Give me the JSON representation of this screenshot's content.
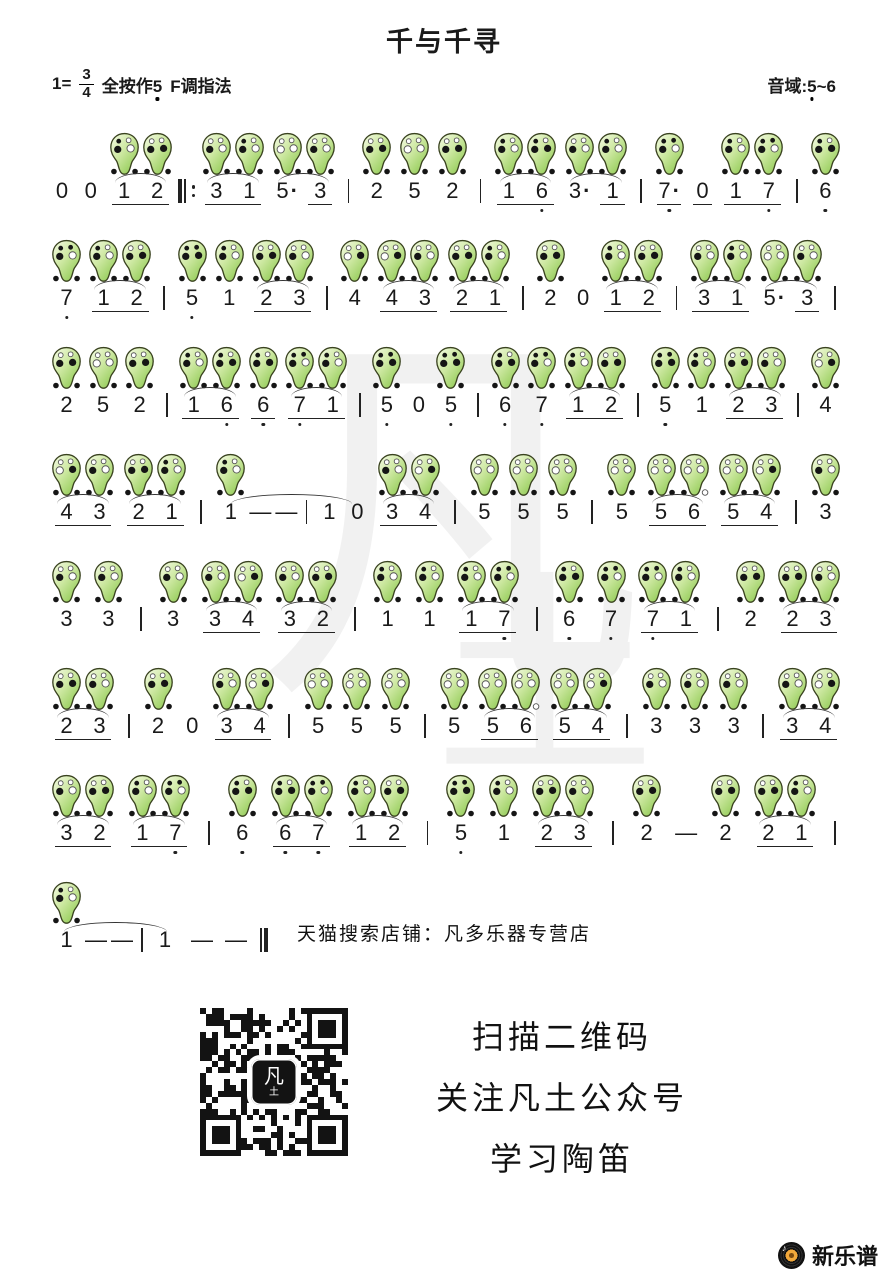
{
  "header": {
    "title": "千与千寻",
    "key": {
      "scale": "1=",
      "num": "3",
      "den": "4",
      "press": "全按作",
      "press_note": "5",
      "fingering": "F调指法"
    },
    "range": {
      "prefix": "音域:",
      "low": "5",
      "sep": "~",
      "high": "6"
    }
  },
  "watermark": {
    "main": "凡",
    "sub": "土"
  },
  "score": {
    "rows": [
      [
        {
          "k": "n",
          "t": "0"
        },
        {
          "k": "n",
          "t": "0"
        },
        {
          "k": "g",
          "slur": true,
          "ul": true,
          "n": [
            {
              "k": "n",
              "t": "1"
            },
            {
              "k": "n",
              "t": "2"
            }
          ]
        },
        {
          "k": "rbar"
        },
        {
          "k": "g",
          "slur": true,
          "ul": true,
          "n": [
            {
              "k": "n",
              "t": "3"
            },
            {
              "k": "n",
              "t": "1"
            }
          ]
        },
        {
          "k": "g",
          "slur": true,
          "n": [
            {
              "k": "n",
              "t": "5",
              "dot": true
            },
            {
              "k": "n",
              "t": "3",
              "ul": true
            }
          ]
        },
        {
          "k": "bar"
        },
        {
          "k": "n",
          "t": "2"
        },
        {
          "k": "n",
          "t": "5"
        },
        {
          "k": "n",
          "t": "2"
        },
        {
          "k": "bar"
        },
        {
          "k": "g",
          "slur": true,
          "ul": true,
          "n": [
            {
              "k": "n",
              "t": "1"
            },
            {
              "k": "n",
              "t": "6",
              "lo": true
            }
          ]
        },
        {
          "k": "g",
          "slur": true,
          "n": [
            {
              "k": "n",
              "t": "3",
              "dot": true
            },
            {
              "k": "n",
              "t": "1",
              "ul": true
            }
          ]
        },
        {
          "k": "bar"
        },
        {
          "k": "n",
          "t": "7",
          "lo": true,
          "dot": true,
          "ul": true
        },
        {
          "k": "n",
          "t": "0",
          "ul": true
        },
        {
          "k": "g",
          "ul": true,
          "n": [
            {
              "k": "n",
              "t": "1"
            },
            {
              "k": "n",
              "t": "7",
              "lo": true
            }
          ]
        },
        {
          "k": "bar"
        },
        {
          "k": "n",
          "t": "6",
          "lo": true
        }
      ],
      [
        {
          "k": "n",
          "t": "7",
          "lo": true
        },
        {
          "k": "g",
          "slur": true,
          "ul": true,
          "n": [
            {
              "k": "n",
              "t": "1"
            },
            {
              "k": "n",
              "t": "2"
            }
          ]
        },
        {
          "k": "bar"
        },
        {
          "k": "n",
          "t": "5",
          "lo": true
        },
        {
          "k": "n",
          "t": "1"
        },
        {
          "k": "g",
          "slur": true,
          "ul": true,
          "n": [
            {
              "k": "n",
              "t": "2"
            },
            {
              "k": "n",
              "t": "3"
            }
          ]
        },
        {
          "k": "bar"
        },
        {
          "k": "n",
          "t": "4"
        },
        {
          "k": "g",
          "slur": true,
          "ul": true,
          "n": [
            {
              "k": "n",
              "t": "4"
            },
            {
              "k": "n",
              "t": "3"
            }
          ]
        },
        {
          "k": "g",
          "slur": true,
          "ul": true,
          "n": [
            {
              "k": "n",
              "t": "2"
            },
            {
              "k": "n",
              "t": "1"
            }
          ]
        },
        {
          "k": "bar"
        },
        {
          "k": "n",
          "t": "2"
        },
        {
          "k": "n",
          "t": "0"
        },
        {
          "k": "g",
          "slur": true,
          "ul": true,
          "n": [
            {
              "k": "n",
              "t": "1"
            },
            {
              "k": "n",
              "t": "2"
            }
          ]
        },
        {
          "k": "bar"
        },
        {
          "k": "g",
          "slur": true,
          "ul": true,
          "n": [
            {
              "k": "n",
              "t": "3"
            },
            {
              "k": "n",
              "t": "1"
            }
          ]
        },
        {
          "k": "g",
          "slur": true,
          "n": [
            {
              "k": "n",
              "t": "5",
              "dot": true
            },
            {
              "k": "n",
              "t": "3",
              "ul": true
            }
          ]
        },
        {
          "k": "bar"
        }
      ],
      [
        {
          "k": "n",
          "t": "2"
        },
        {
          "k": "n",
          "t": "5"
        },
        {
          "k": "n",
          "t": "2"
        },
        {
          "k": "bar"
        },
        {
          "k": "g",
          "slur": true,
          "ul": true,
          "n": [
            {
              "k": "n",
              "t": "1"
            },
            {
              "k": "n",
              "t": "6",
              "lo": true
            }
          ]
        },
        {
          "k": "n",
          "t": "6",
          "lo": true,
          "ul": true
        },
        {
          "k": "g",
          "slur": true,
          "ul": true,
          "n": [
            {
              "k": "n",
              "t": "7",
              "lo": true
            },
            {
              "k": "n",
              "t": "1"
            }
          ]
        },
        {
          "k": "bar"
        },
        {
          "k": "n",
          "t": "5",
          "lo": true
        },
        {
          "k": "n",
          "t": "0"
        },
        {
          "k": "n",
          "t": "5",
          "lo": true
        },
        {
          "k": "bar"
        },
        {
          "k": "n",
          "t": "6",
          "lo": true
        },
        {
          "k": "n",
          "t": "7",
          "lo": true
        },
        {
          "k": "g",
          "slur": true,
          "ul": true,
          "n": [
            {
              "k": "n",
              "t": "1"
            },
            {
              "k": "n",
              "t": "2"
            }
          ]
        },
        {
          "k": "bar"
        },
        {
          "k": "n",
          "t": "5",
          "lo": true
        },
        {
          "k": "n",
          "t": "1"
        },
        {
          "k": "g",
          "slur": true,
          "ul": true,
          "n": [
            {
              "k": "n",
              "t": "2"
            },
            {
              "k": "n",
              "t": "3"
            }
          ]
        },
        {
          "k": "bar"
        },
        {
          "k": "n",
          "t": "4"
        }
      ],
      [
        {
          "k": "g",
          "slur": true,
          "ul": true,
          "n": [
            {
              "k": "n",
              "t": "4"
            },
            {
              "k": "n",
              "t": "3"
            }
          ]
        },
        {
          "k": "g",
          "slur": true,
          "ul": true,
          "n": [
            {
              "k": "n",
              "t": "2"
            },
            {
              "k": "n",
              "t": "1"
            }
          ]
        },
        {
          "k": "bar"
        },
        {
          "k": "g",
          "slur": true,
          "n": [
            {
              "k": "n",
              "t": "1"
            },
            {
              "k": "d"
            },
            {
              "k": "d"
            },
            {
              "k": "bar"
            },
            {
              "k": "n",
              "t": "1",
              "oc": false
            },
            {
              "k": "n",
              "t": "0"
            }
          ]
        },
        {
          "k": "g",
          "slur": true,
          "ul": true,
          "n": [
            {
              "k": "n",
              "t": "3"
            },
            {
              "k": "n",
              "t": "4"
            }
          ]
        },
        {
          "k": "bar"
        },
        {
          "k": "n",
          "t": "5"
        },
        {
          "k": "n",
          "t": "5"
        },
        {
          "k": "n",
          "t": "5"
        },
        {
          "k": "bar"
        },
        {
          "k": "n",
          "t": "5"
        },
        {
          "k": "g",
          "slur": true,
          "ul": true,
          "n": [
            {
              "k": "n",
              "t": "5"
            },
            {
              "k": "n",
              "t": "6"
            }
          ]
        },
        {
          "k": "g",
          "slur": true,
          "ul": true,
          "n": [
            {
              "k": "n",
              "t": "5"
            },
            {
              "k": "n",
              "t": "4"
            }
          ]
        },
        {
          "k": "bar"
        },
        {
          "k": "n",
          "t": "3"
        }
      ],
      [
        {
          "k": "n",
          "t": "3"
        },
        {
          "k": "n",
          "t": "3"
        },
        {
          "k": "bar"
        },
        {
          "k": "n",
          "t": "3"
        },
        {
          "k": "g",
          "slur": true,
          "ul": true,
          "n": [
            {
              "k": "n",
              "t": "3"
            },
            {
              "k": "n",
              "t": "4"
            }
          ]
        },
        {
          "k": "g",
          "slur": true,
          "ul": true,
          "n": [
            {
              "k": "n",
              "t": "3"
            },
            {
              "k": "n",
              "t": "2"
            }
          ]
        },
        {
          "k": "bar"
        },
        {
          "k": "n",
          "t": "1"
        },
        {
          "k": "n",
          "t": "1"
        },
        {
          "k": "g",
          "slur": true,
          "ul": true,
          "n": [
            {
              "k": "n",
              "t": "1"
            },
            {
              "k": "n",
              "t": "7",
              "lo": true
            }
          ]
        },
        {
          "k": "bar"
        },
        {
          "k": "n",
          "t": "6",
          "lo": true
        },
        {
          "k": "n",
          "t": "7",
          "lo": true
        },
        {
          "k": "g",
          "slur": true,
          "ul": true,
          "n": [
            {
              "k": "n",
              "t": "7",
              "lo": true
            },
            {
              "k": "n",
              "t": "1"
            }
          ]
        },
        {
          "k": "bar"
        },
        {
          "k": "n",
          "t": "2"
        },
        {
          "k": "g",
          "slur": true,
          "ul": true,
          "n": [
            {
              "k": "n",
              "t": "2"
            },
            {
              "k": "n",
              "t": "3"
            }
          ]
        }
      ],
      [
        {
          "k": "g",
          "slur": true,
          "ul": true,
          "n": [
            {
              "k": "n",
              "t": "2"
            },
            {
              "k": "n",
              "t": "3"
            }
          ]
        },
        {
          "k": "bar"
        },
        {
          "k": "n",
          "t": "2"
        },
        {
          "k": "n",
          "t": "0"
        },
        {
          "k": "g",
          "slur": true,
          "ul": true,
          "n": [
            {
              "k": "n",
              "t": "3"
            },
            {
              "k": "n",
              "t": "4"
            }
          ]
        },
        {
          "k": "bar"
        },
        {
          "k": "n",
          "t": "5"
        },
        {
          "k": "n",
          "t": "5"
        },
        {
          "k": "n",
          "t": "5"
        },
        {
          "k": "bar"
        },
        {
          "k": "n",
          "t": "5"
        },
        {
          "k": "g",
          "slur": true,
          "ul": true,
          "n": [
            {
              "k": "n",
              "t": "5"
            },
            {
              "k": "n",
              "t": "6"
            }
          ]
        },
        {
          "k": "g",
          "slur": true,
          "ul": true,
          "n": [
            {
              "k": "n",
              "t": "5"
            },
            {
              "k": "n",
              "t": "4"
            }
          ]
        },
        {
          "k": "bar"
        },
        {
          "k": "n",
          "t": "3"
        },
        {
          "k": "n",
          "t": "3"
        },
        {
          "k": "n",
          "t": "3"
        },
        {
          "k": "bar"
        },
        {
          "k": "g",
          "slur": true,
          "ul": true,
          "n": [
            {
              "k": "n",
              "t": "3"
            },
            {
              "k": "n",
              "t": "4"
            }
          ]
        }
      ],
      [
        {
          "k": "g",
          "slur": true,
          "ul": true,
          "n": [
            {
              "k": "n",
              "t": "3"
            },
            {
              "k": "n",
              "t": "2"
            }
          ]
        },
        {
          "k": "g",
          "slur": true,
          "ul": true,
          "n": [
            {
              "k": "n",
              "t": "1"
            },
            {
              "k": "n",
              "t": "7",
              "lo": true
            }
          ]
        },
        {
          "k": "bar"
        },
        {
          "k": "n",
          "t": "6",
          "lo": true
        },
        {
          "k": "g",
          "slur": true,
          "ul": true,
          "n": [
            {
              "k": "n",
              "t": "6",
              "lo": true
            },
            {
              "k": "n",
              "t": "7",
              "lo": true
            }
          ]
        },
        {
          "k": "g",
          "slur": true,
          "ul": true,
          "n": [
            {
              "k": "n",
              "t": "1"
            },
            {
              "k": "n",
              "t": "2"
            }
          ]
        },
        {
          "k": "bar"
        },
        {
          "k": "n",
          "t": "5",
          "lo": true
        },
        {
          "k": "n",
          "t": "1"
        },
        {
          "k": "g",
          "slur": true,
          "ul": true,
          "n": [
            {
              "k": "n",
              "t": "2"
            },
            {
              "k": "n",
              "t": "3"
            }
          ]
        },
        {
          "k": "bar"
        },
        {
          "k": "n",
          "t": "2"
        },
        {
          "k": "d"
        },
        {
          "k": "n",
          "t": "2"
        },
        {
          "k": "g",
          "slur": true,
          "ul": true,
          "n": [
            {
              "k": "n",
              "t": "2"
            },
            {
              "k": "n",
              "t": "1"
            }
          ]
        },
        {
          "k": "bar"
        }
      ],
      [
        {
          "k": "g",
          "slur": true,
          "n": [
            {
              "k": "n",
              "t": "1"
            },
            {
              "k": "d"
            },
            {
              "k": "d"
            },
            {
              "k": "bar"
            },
            {
              "k": "n",
              "t": "1",
              "oc": false
            }
          ]
        },
        {
          "k": "d"
        },
        {
          "k": "d"
        },
        {
          "k": "fbar"
        }
      ]
    ]
  },
  "fingerings": {
    "5L": {
      "h": [
        1,
        1,
        1,
        1
      ],
      "th": [
        1,
        1
      ]
    },
    "6L": {
      "h": [
        1,
        0,
        1,
        1
      ],
      "th": [
        1,
        1
      ]
    },
    "7L": {
      "h": [
        1,
        1,
        1,
        0
      ],
      "th": [
        1,
        1
      ]
    },
    "1": {
      "h": [
        1,
        0,
        1,
        0
      ],
      "th": [
        1,
        1
      ]
    },
    "2": {
      "h": [
        0,
        0,
        1,
        1
      ],
      "th": [
        1,
        1
      ]
    },
    "3": {
      "h": [
        0,
        0,
        1,
        0
      ],
      "th": [
        1,
        1
      ]
    },
    "4": {
      "h": [
        0,
        0,
        0,
        1
      ],
      "th": [
        1,
        1
      ]
    },
    "5": {
      "h": [
        0,
        0,
        0,
        0
      ],
      "th": [
        1,
        1
      ]
    },
    "6": {
      "h": [
        0,
        0,
        0,
        0
      ],
      "th": [
        1,
        0
      ]
    }
  },
  "footer": {
    "shop_text": "天猫搜索店铺：凡多乐器专营店",
    "qr_lines": [
      "扫描二维码",
      "关注凡土公众号",
      "学习陶笛"
    ],
    "qr_logo_main": "凡",
    "qr_logo_sub": "土",
    "brand": "新乐谱"
  },
  "colors": {
    "ocarina_gradient": [
      "#f5fbe6",
      "#cfe9a4",
      "#8cc84e"
    ],
    "ocarina_outline": "#39421f",
    "hole_fill": "#151515",
    "ink": "#1a1a1a",
    "vinyl_label": "#f2a93b",
    "brand_text": "#111111"
  }
}
